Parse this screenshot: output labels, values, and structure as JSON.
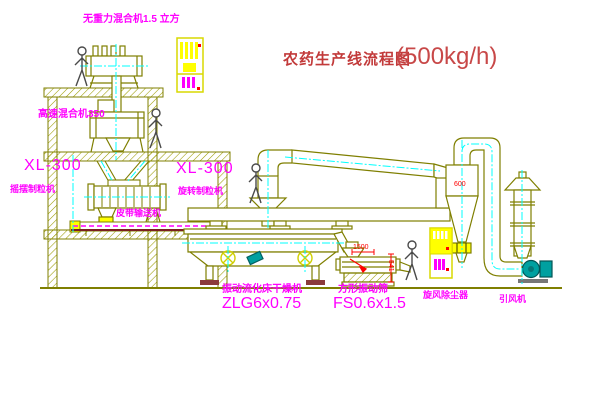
{
  "title": {
    "name": "农药生产线流程图",
    "capacity": "(500kg/h)"
  },
  "labels": {
    "gravity_mixer": "无重力混合机1.5 立方",
    "high_speed_mixer": "高速混合机350",
    "granulator_left_model": "XL-300",
    "granulator_left_name": "摇摆制粒机",
    "granulator_right_model": "XL-300",
    "granulator_right_name": "旋转制粒机",
    "belt_conveyor": "皮带输送机",
    "dryer_name": "振动流化床干燥机",
    "dryer_model": "ZLG6x0.75",
    "sieve_name": "方形振动筛",
    "sieve_model": "FS0.6x1.5",
    "cyclone_name": "旋风除尘器",
    "fan_name": "引风机"
  },
  "dimensions": {
    "cyclone_diameter": "600",
    "sieve_length": "1500",
    "sieve_height": "541"
  },
  "colors": {
    "label": "#ff00ff",
    "title": "#c23a3a",
    "dimension": "#ff0000",
    "drawing_line": "#7f7f00",
    "centerline": "#00ffff",
    "highlight": "#ffff00",
    "fan": "#00a0a0",
    "conveyor": "#7a1f1f"
  }
}
